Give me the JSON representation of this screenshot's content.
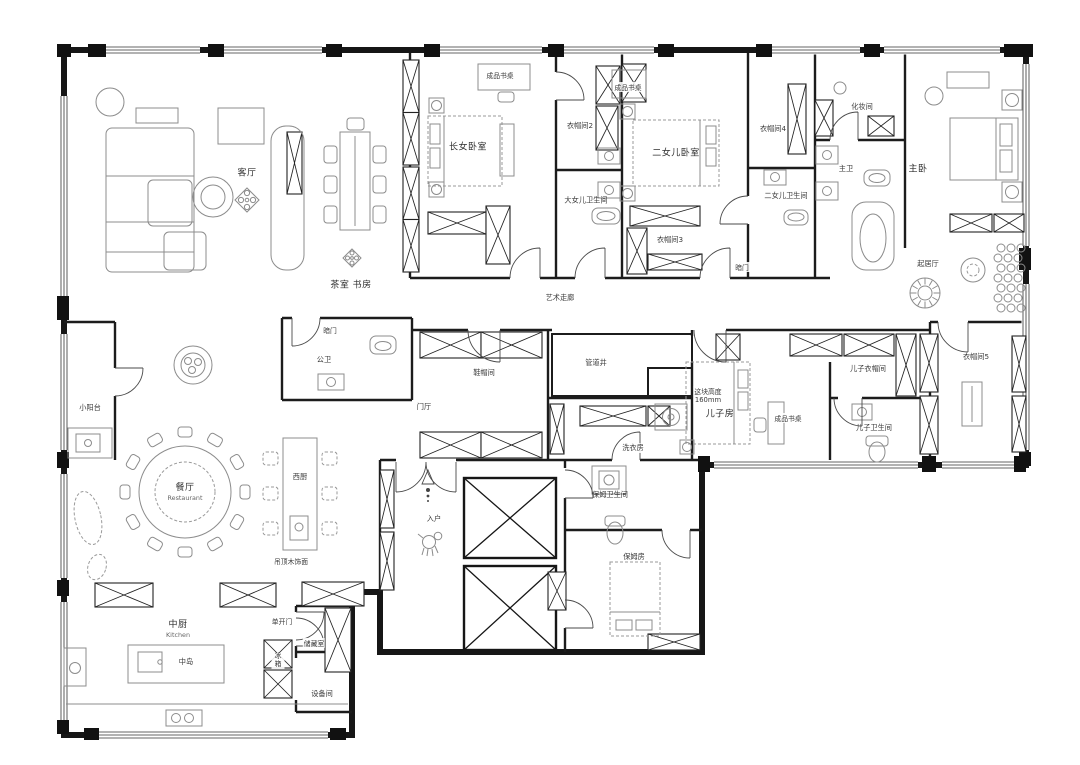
{
  "meta": {
    "kind": "residential floor plan",
    "language": "zh-CN"
  },
  "colors": {
    "wall": "#161616",
    "interior_wall": "#1c1c1c",
    "furniture_line": "#8c8c8c",
    "door_line": "#4a4a4a",
    "text": "#2e2e2e",
    "background": "#ffffff"
  },
  "labels": {
    "living": "客厅",
    "tea_study": "茶室 书房",
    "art_corridor": "艺术走廊",
    "eldest_bedroom": "长女卧室",
    "cloak2": "衣帽间2",
    "eldest_bath": "大女儿卫生间",
    "second_bedroom": "二女儿卧室",
    "cloak3": "衣帽间3",
    "cloak4": "衣帽间4",
    "second_bath": "二女儿卫生间",
    "makeup_room": "化妆间",
    "master_bath": "主卫",
    "master_bedroom": "主卧",
    "sitting_room": "起居厅",
    "hidden_door_a": "暗门",
    "hidden_door_b": "暗门",
    "public_bath": "公卫",
    "foyer": "门厅",
    "shoe_hat_room": "鞋帽间",
    "pipe_shaft": "管道井",
    "laundry": "洗衣房",
    "son_room": "儿子房",
    "son_cloak": "儿子衣帽间",
    "son_bath": "儿子卫生间",
    "cloak5": "衣帽间5",
    "balcony": "小阳台",
    "restaurant_zh": "餐厅",
    "restaurant_en": "Restaurant",
    "west_kitchen": "西厨",
    "kitchen_zh": "中厨",
    "kitchen_en": "Kitchen",
    "island": "中岛",
    "fridge": "冰箱",
    "single_door": "单开门",
    "storage": "储藏室",
    "equipment": "设备间",
    "entry": "入户",
    "nanny_bath": "保姆卫生间",
    "nanny_room": "保姆房",
    "desk_a": "成品书桌",
    "desk_b": "成品书桌",
    "desk_c": "成品书桌",
    "height_note_line1": "这块高度",
    "height_note_line2": "160mm",
    "ceiling_note": "吊顶木饰面"
  }
}
